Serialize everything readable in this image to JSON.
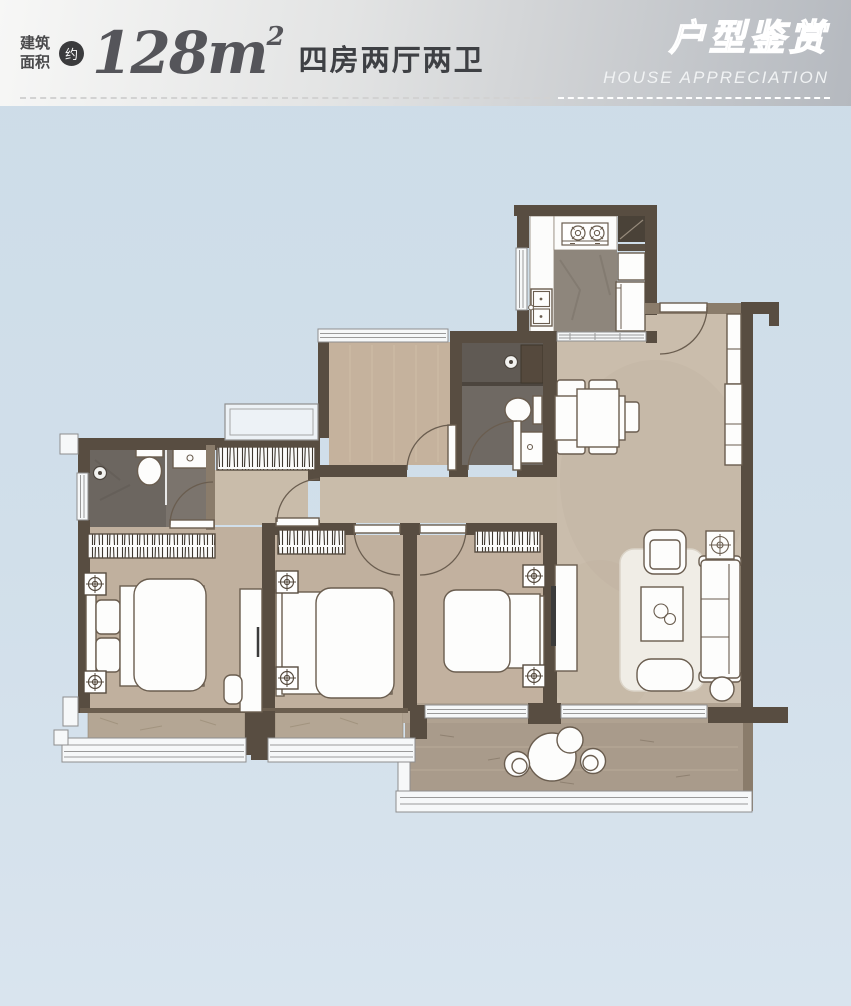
{
  "header": {
    "area_label_line1": "建筑",
    "area_label_line2": "面积",
    "approx_badge": "约",
    "area_value": "128",
    "area_unit": "m",
    "area_sup": "2",
    "layout_text": "四房两厅两卫",
    "title_cn": "户型鉴赏",
    "title_en": "HOUSE APPRECIATION"
  },
  "colors": {
    "page_bg": "#cfdde9",
    "header_bg_left": "#f6f6f5",
    "header_bg_right": "#b5b9bf",
    "wall": "#584d41",
    "wall_light": "#8a7c6b",
    "floor_living": "#cabdac",
    "floor_bedroom": "#c0b09e",
    "floor_study": "#c5b29d",
    "floor_bath": "#7b746d",
    "bay_sill": "#b4a694",
    "balcony_floor": "#a99b8b",
    "furniture_stroke": "#6a5d4f",
    "badge_bg": "#3b3b3d"
  }
}
